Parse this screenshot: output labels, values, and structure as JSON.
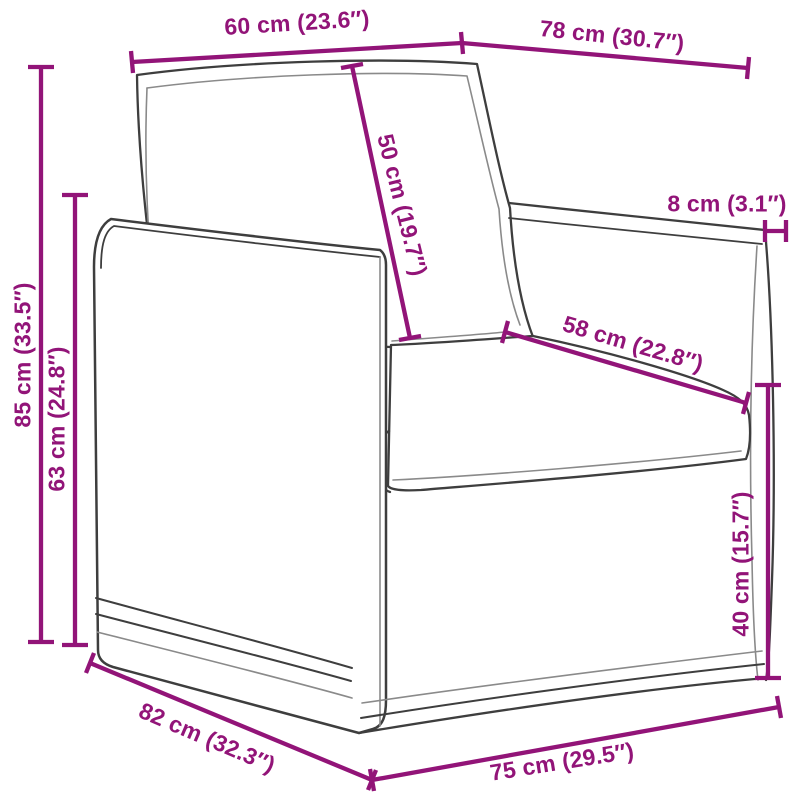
{
  "meta": {
    "title": "Armchair dimension diagram",
    "type": "product-dimension-diagram",
    "subject": "armchair line drawing",
    "canvas": {
      "width": 800,
      "height": 800,
      "background": "#ffffff"
    }
  },
  "style": {
    "dimension_color": "#921478",
    "outline_color": "#3e3e3e",
    "secondary_line_color": "#8a8a8a"
  },
  "dimensions": [
    {
      "id": "back-cushion-width",
      "cm": 60,
      "inches": 23.6,
      "label": "60 cm (23.6″)"
    },
    {
      "id": "top-depth",
      "cm": 78,
      "inches": 30.7,
      "label": "78 cm (30.7″)"
    },
    {
      "id": "back-cushion-height",
      "cm": 50,
      "inches": 19.7,
      "label": "50 cm (19.7″)"
    },
    {
      "id": "armrest-width",
      "cm": 8,
      "inches": 3.1,
      "label": "8 cm (3.1″)"
    },
    {
      "id": "seat-depth",
      "cm": 58,
      "inches": 22.8,
      "label": "58 cm (22.8″)"
    },
    {
      "id": "total-height",
      "cm": 85,
      "inches": 33.5,
      "label": "85 cm (33.5″)"
    },
    {
      "id": "arm-height",
      "cm": 63,
      "inches": 24.8,
      "label": "63 cm (24.8″)"
    },
    {
      "id": "seat-height",
      "cm": 40,
      "inches": 15.7,
      "label": "40 cm (15.7″)"
    },
    {
      "id": "side-depth",
      "cm": 82,
      "inches": 32.3,
      "label": "82 cm (32.3″)"
    },
    {
      "id": "front-width",
      "cm": 75,
      "inches": 29.5,
      "label": "75 cm (29.5″)"
    }
  ]
}
